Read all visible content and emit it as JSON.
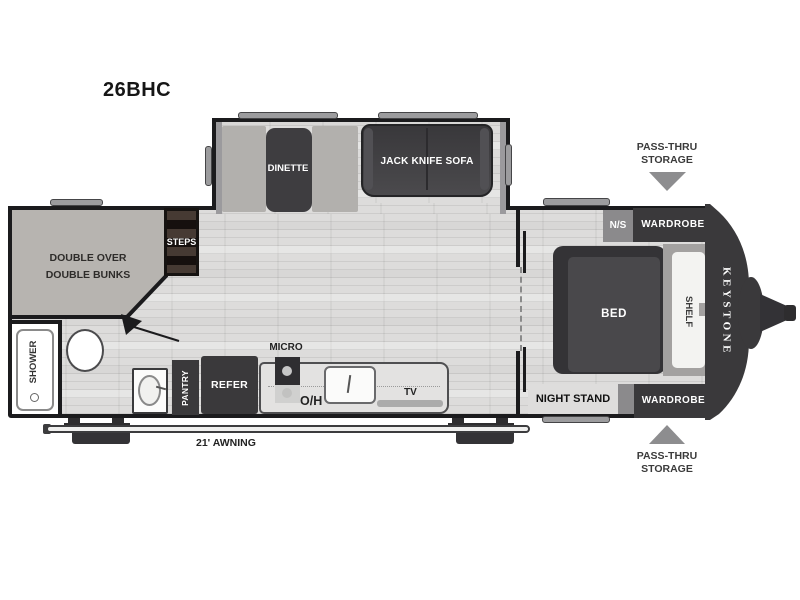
{
  "title": "26BHC",
  "slideout": {
    "dinette": "DINETTE",
    "sofa": "JACK KNIFE SOFA"
  },
  "bunk_area": {
    "line1": "DOUBLE OVER",
    "line2": "DOUBLE BUNKS",
    "steps": "STEPS"
  },
  "bathroom": {
    "shower": "SHOWER"
  },
  "kitchen": {
    "pantry": "PANTRY",
    "refer": "REFER",
    "micro": "MICRO",
    "overhead": "O/H",
    "tv": "TV"
  },
  "bedroom": {
    "ns": "N/S",
    "wardrobe_top": "WARDROBE",
    "bed": "BED",
    "shelf": "SHELF",
    "night_stand": "NIGHT STAND",
    "wardrobe_bottom": "WARDROBE"
  },
  "exterior": {
    "brand": "KEYSTONE",
    "awning": "21' AWNING",
    "pass_thru_top": {
      "line1": "PASS-THRU",
      "line2": "STORAGE"
    },
    "pass_thru_bottom": {
      "line1": "PASS-THRU",
      "line2": "STORAGE"
    }
  },
  "colors": {
    "wall": "#1b1b1d",
    "furniture_dark": "#3a393b",
    "floor": "#dddcdb",
    "bunk": "#b7b4b0",
    "counter": "#e3e2e1",
    "arrow": "#8d8d8f",
    "window": "#9c9c9e"
  }
}
